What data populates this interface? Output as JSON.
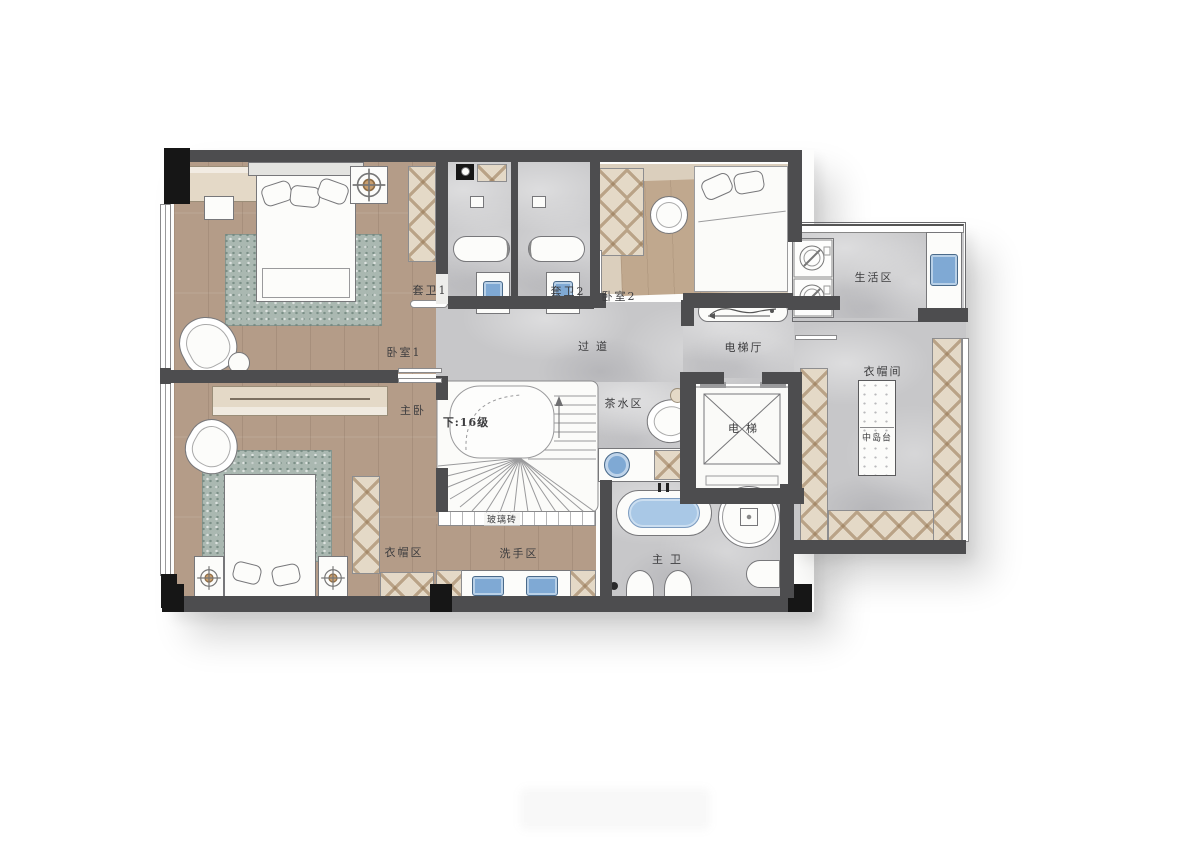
{
  "labels": {
    "bedroom1": "卧室1",
    "master_bedroom": "主卧",
    "suite_bath1": "套卫1",
    "suite_bath2": "套卫2",
    "bedroom2": "卧室2",
    "corridor": "过道",
    "elevator_hall": "电梯厅",
    "elevator": "电梯",
    "tea_area": "茶水区",
    "stairs_down": "下:16级",
    "glass_brick": "玻璃砖",
    "living_area": "生活区",
    "cloakroom": "衣帽间",
    "island": "中岛台",
    "wardrobe_area": "衣帽区",
    "wash_area": "洗手区",
    "master_bath": "主卫"
  },
  "colors": {
    "wall": "#4d4d4f",
    "column": "#161616",
    "wood": "#b49c88",
    "wood_light": "#c0a88e",
    "floor_tan": "#dbcfbd",
    "marble": "#c7c7c9",
    "rug": "#aab8b1",
    "cabinet": "#e4d9c7",
    "fixture_white": "#fcfcfa",
    "outline": "#77777a",
    "water_blue": "#a9c8e6",
    "sink_blue": "#7fa9d4",
    "label": "#3d3d3f"
  }
}
